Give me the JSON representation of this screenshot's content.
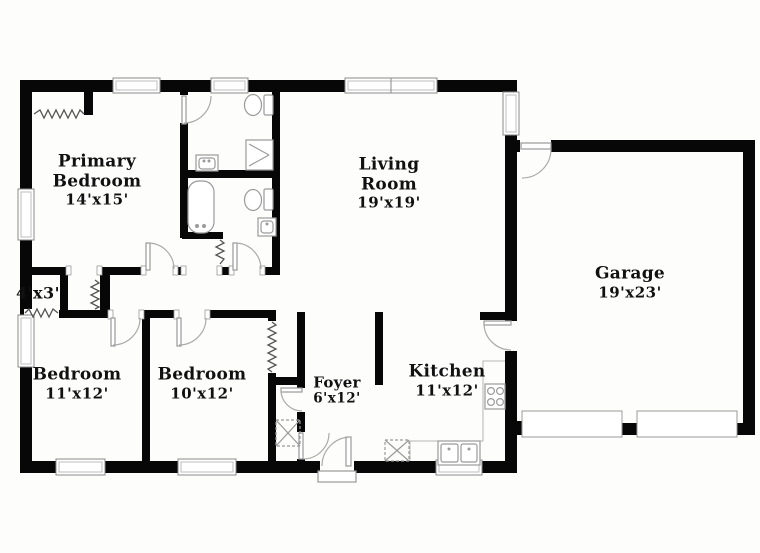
{
  "floorplan": {
    "rooms": [
      {
        "name": "Primary Bedroom",
        "dimensions": "14'x15'"
      },
      {
        "name": "",
        "dimensions": "4'x3'"
      },
      {
        "name": "Living Room",
        "dimensions": "19'x19'"
      },
      {
        "name": "Garage",
        "dimensions": "19'x23'"
      },
      {
        "name": "Bedroom",
        "dimensions": "11'x12'"
      },
      {
        "name": "Bedroom",
        "dimensions": "10'x12'"
      },
      {
        "name": "Foyer",
        "dimensions": "6'x12'"
      },
      {
        "name": "Kitchen",
        "dimensions": "11'x12'"
      }
    ],
    "colors": {
      "walls": "#070707",
      "background": "#ffffff",
      "fixtures": "#9a9a9a",
      "text": "#111111"
    }
  }
}
